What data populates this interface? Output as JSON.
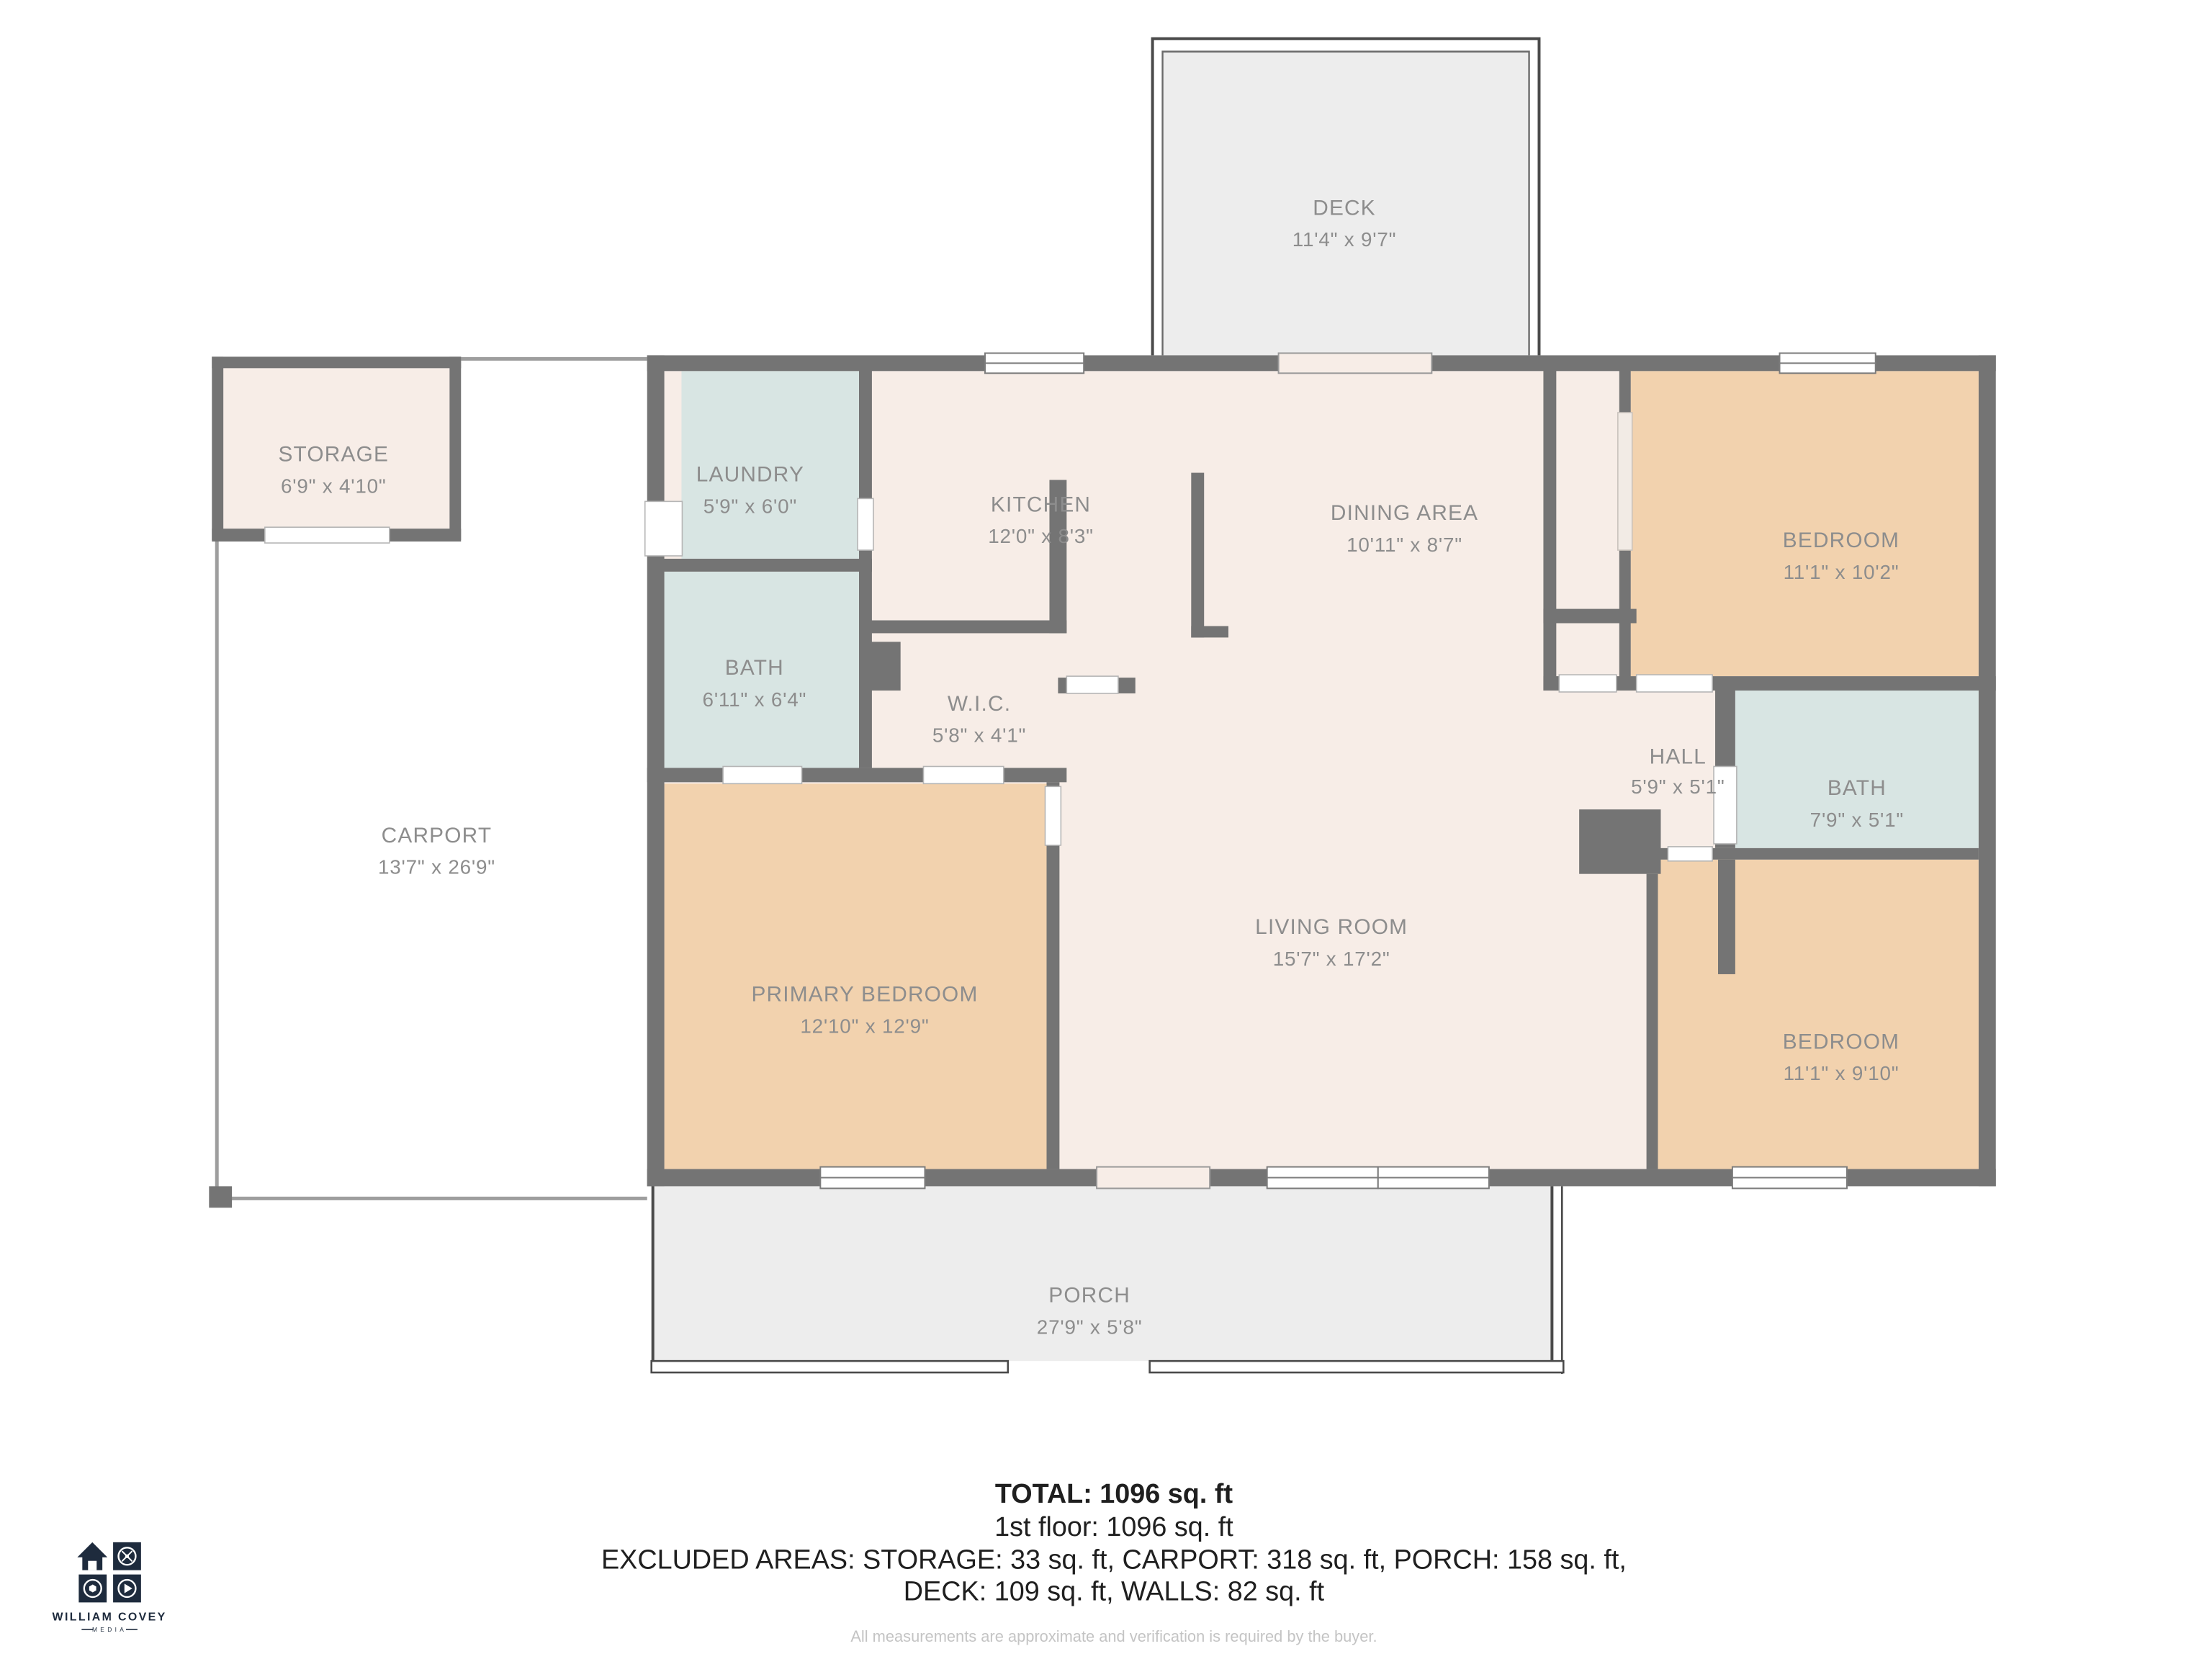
{
  "palette": {
    "wall": "#747474",
    "cream": "#f7ede7",
    "tan": "#f2d2ae",
    "blue": "#d8e5e3",
    "grayarea": "#ededed",
    "label": "#8d8d8d",
    "thin": "#4a4a4a",
    "carline": "#9e9e9e",
    "navy": "#1e2b3d",
    "textdark": "#1f1f1f",
    "faint": "#c4c4c4"
  },
  "rooms": {
    "deck": {
      "name": "DECK",
      "dims": "11'4\" x 9'7\""
    },
    "storage": {
      "name": "STORAGE",
      "dims": "6'9\" x 4'10\""
    },
    "laundry": {
      "name": "LAUNDRY",
      "dims": "5'9\" x 6'0\""
    },
    "kitchen": {
      "name": "KITCHEN",
      "dims": "12'0\" x 8'3\""
    },
    "dining": {
      "name": "DINING AREA",
      "dims": "10'11\" x 8'7\""
    },
    "bedroom_tr": {
      "name": "BEDROOM",
      "dims": "11'1\" x 10'2\""
    },
    "bath_left": {
      "name": "BATH",
      "dims": "6'11\" x 6'4\""
    },
    "wic": {
      "name": "W.I.C.",
      "dims": "5'8\" x 4'1\""
    },
    "hall": {
      "name": "HALL",
      "dims": "5'9\" x 5'1\""
    },
    "bath_right": {
      "name": "BATH",
      "dims": "7'9\" x 5'1\""
    },
    "carport": {
      "name": "CARPORT",
      "dims": "13'7\" x 26'9\""
    },
    "primary": {
      "name": "PRIMARY BEDROOM",
      "dims": "12'10\" x 12'9\""
    },
    "living": {
      "name": "LIVING ROOM",
      "dims": "15'7\" x 17'2\""
    },
    "bedroom_br": {
      "name": "BEDROOM",
      "dims": "11'1\" x 9'10\""
    },
    "porch": {
      "name": "PORCH",
      "dims": "27'9\" x 5'8\""
    }
  },
  "footer": {
    "total": "TOTAL: 1096 sq. ft",
    "floor": "1st floor: 1096 sq. ft",
    "excluded_line1": "EXCLUDED AREAS: STORAGE: 33 sq. ft, CARPORT: 318 sq. ft, PORCH: 158 sq. ft,",
    "excluded_line2": "DECK: 109 sq. ft, WALLS: 82 sq. ft",
    "disclaimer": "All measurements are approximate and verification is required by the buyer."
  },
  "logo": {
    "name": "WILLIAM COVEY",
    "tagline": "MEDIA"
  }
}
